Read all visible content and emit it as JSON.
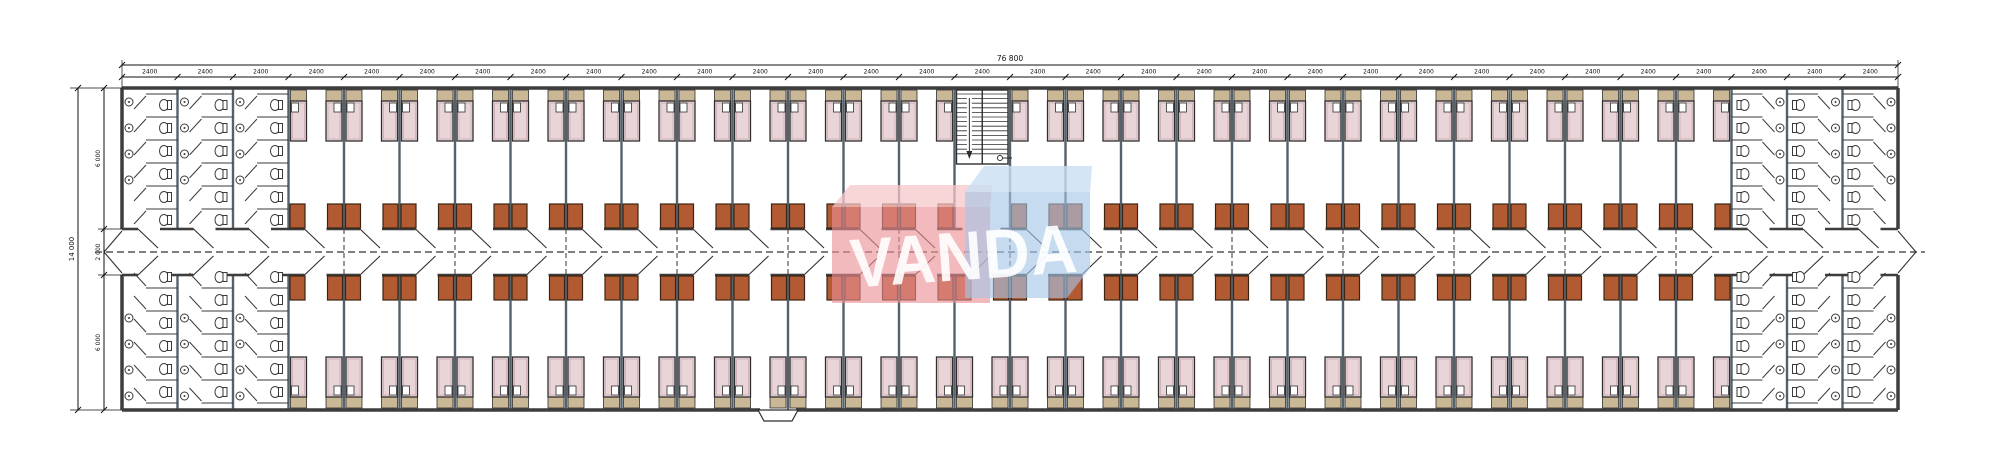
{
  "document": {
    "type": "architectural-floor-plan",
    "subject": "long dormitory block — bedrooms along central corridor with washrooms at both ends and a central staircase"
  },
  "watermark": {
    "text": "VANDA",
    "text_color": "rgba(255,255,255,0.9)",
    "pink_face": "rgba(236,143,150,0.62)",
    "pink_top": "rgba(246,199,202,0.75)",
    "blue_face": "rgba(165,197,231,0.62)",
    "blue_top": "rgba(202,223,244,0.8)"
  },
  "dimensions": {
    "total_width_label": "76 800",
    "bay_width_label": "2400",
    "bay_count": 32,
    "total_height_label": "14 000",
    "height_segment_labels": [
      "6 000",
      "2 000",
      "6 000"
    ]
  },
  "plan": {
    "building": {
      "x1": 122,
      "x2": 1898,
      "y1": 88,
      "y2": 410
    },
    "corridor": {
      "y1": 229,
      "y2": 275,
      "center": 252
    },
    "stair_bay": 15,
    "washroom_bays_left": [
      0,
      1,
      2
    ],
    "washroom_bays_right": [
      29,
      30,
      31
    ],
    "room_bays_top": "3-14 and 16-28",
    "room_bays_bottom": "3-28",
    "counts": {
      "rooms_top": 25,
      "rooms_bottom": 26,
      "beds_total": 102,
      "wardrobes_total": 102
    },
    "entrance": {
      "position": "bottom wall, center-left",
      "x": 778
    },
    "icons": {
      "bed-icon": "pink mattress with tan headboard and white pillow",
      "wardrobe-icon": "brown rectangle at corridor wall",
      "toilet-icon": "bowl with tank in stall",
      "basin-icon": "small circle on wall",
      "stair-icon": "double flight with treads and down arrow",
      "door-swing-icon": "diagonal leaf line at corridor opening"
    },
    "colors": {
      "line": "#2f2f2f",
      "wall": "#3d3d3d",
      "partition": "#55616b",
      "bed": "#e9d4d8",
      "bed_inner": "#c7a8ae",
      "headboard": "#c9b795",
      "pillow": "#ffffff",
      "wardrobe": "#b25b33",
      "wardrobe_stroke": "#3a2414",
      "fixture": "#3a3a3a",
      "dash": "#333333",
      "dim": "#111111"
    }
  }
}
